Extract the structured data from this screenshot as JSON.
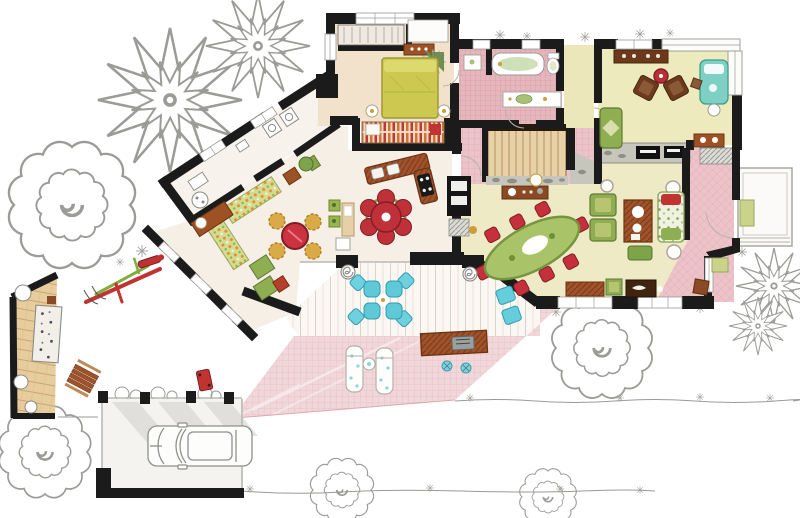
{
  "meta": {
    "kind": "hand-drawn watercolor floor plan illustration",
    "text_visible": "none"
  },
  "palette": {
    "wall": "#1b1b1b",
    "sketch": "#9a9a95",
    "cream": "#f6efe5",
    "tan": "#f2e1cb",
    "yellow": "#eeeac5",
    "yellowStudy": "#edeabd",
    "yellowHall": "#ece7bb",
    "bedYellow": "#cdc84f",
    "bedYellowLight": "#dcd96e",
    "sofaGreen": "#8fae52",
    "sofaGreenDark": "#5f7a33",
    "sofaGreenLight": "#b7c470",
    "plantGreen": "#5d7f3d",
    "chairRed": "#c5303c",
    "chairRedDark": "#7e1f26",
    "gold": "#d9aa45",
    "goldDark": "#b07f23",
    "wood": "#9c5224",
    "woodDark": "#6b340f",
    "woodDeep": "#3f2410",
    "sideboard": "#8a4a26",
    "aqua": "#5fc9d8",
    "aquaDark": "#2f9fb0",
    "teal": "#7ed0c4",
    "tealDark": "#3f9a8d",
    "stone": "#c6c6bc",
    "stoneDot": "#8f8f85",
    "stairTan": "#e9d1a6",
    "stairEdge": "#241a10",
    "mat": "#c9d48a",
    "matDark": "#9aa85a",
    "dining": "#a9c468",
    "diningDark": "#76953f",
    "grill": "#9aa0a0",
    "grillDark": "#5f6565",
    "white": "#ffffff",
    "shadow": "#d2d2cd"
  },
  "rooms": [
    {
      "id": "garden",
      "name": "garden with sketched trees"
    },
    {
      "id": "laundry-wing",
      "name": "diagonal laundry wing"
    },
    {
      "id": "breakfast-nook",
      "name": "breakfast nook with floral banquette"
    },
    {
      "id": "kitchen",
      "name": "kitchen with L-shaped island"
    },
    {
      "id": "master-bedroom",
      "name": "bedroom with yellow bed"
    },
    {
      "id": "bathroom",
      "name": "pink tiled bathroom"
    },
    {
      "id": "hallway",
      "name": "pink stair hall"
    },
    {
      "id": "staircase",
      "name": "staircase"
    },
    {
      "id": "study",
      "name": "study with fireplace"
    },
    {
      "id": "great-room",
      "name": "great room / dining area"
    },
    {
      "id": "entry-hall",
      "name": "pink entry hall"
    },
    {
      "id": "entry-porch",
      "name": "front porch with mat"
    },
    {
      "id": "covered-porch",
      "name": "covered plank porch"
    },
    {
      "id": "terrace",
      "name": "pink tiled terrace"
    },
    {
      "id": "side-deck",
      "name": "wooden side deck"
    },
    {
      "id": "garage",
      "name": "carport with sketched car"
    }
  ],
  "furniture": [
    "bed",
    "wardrobe",
    "dresser",
    "closet",
    "bathtub",
    "toilet",
    "vanity",
    "banquette",
    "breakfast-table",
    "gold-chairs",
    "kitchen-island",
    "stove",
    "sink",
    "flower-table",
    "oven-column",
    "dining-oval-table",
    "dining-chairs",
    "green-armchairs",
    "coffee-table",
    "floral-sofa",
    "ottoman",
    "sideboard",
    "fireplace",
    "brown-armchairs",
    "teal-daybed",
    "green-sofa",
    "desk",
    "aqua-patio-set",
    "loungers",
    "bar-table",
    "grill",
    "stools",
    "deck-bench",
    "picnic-table",
    "play-structure",
    "toy-cart",
    "car"
  ],
  "vegetation": [
    "poinsettia-tree",
    "cloud-tree",
    "shrub-row",
    "grass-tufts"
  ]
}
